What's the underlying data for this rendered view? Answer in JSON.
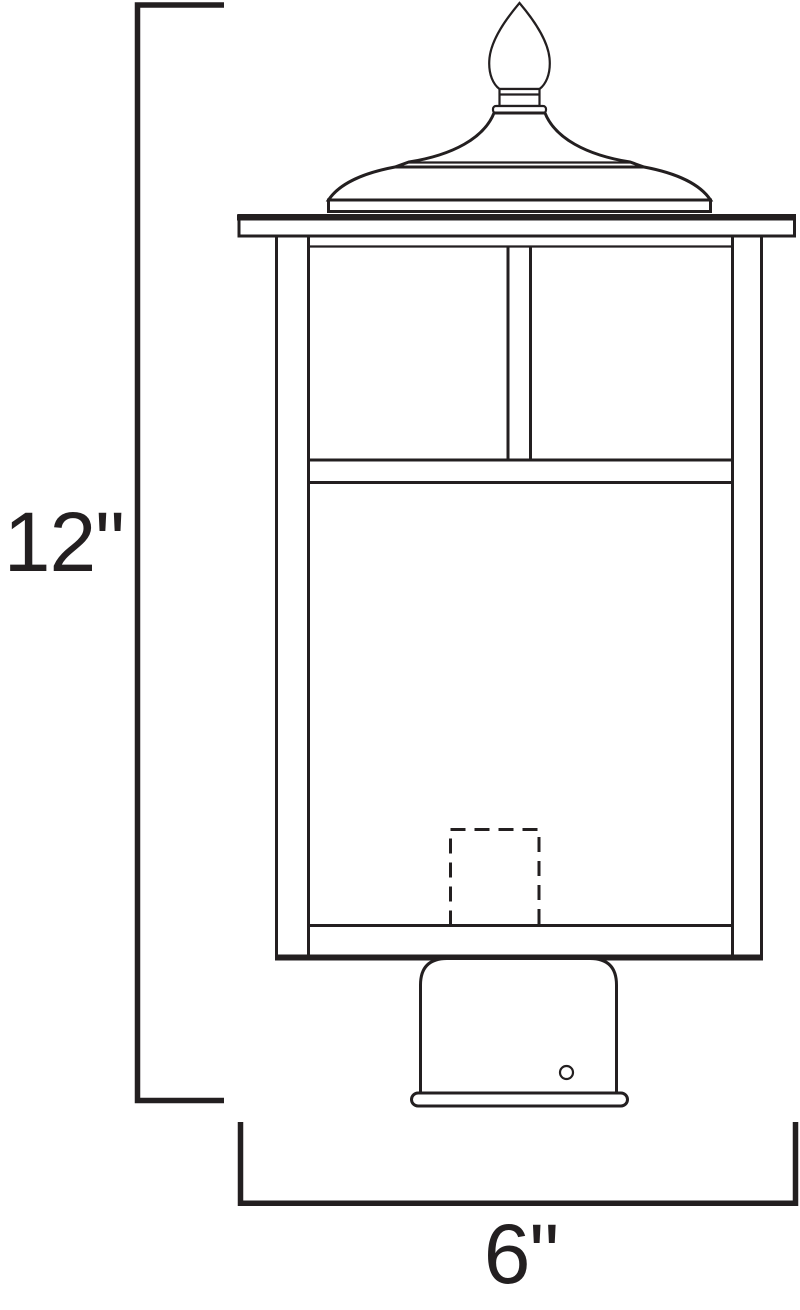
{
  "diagram": {
    "height_label": "12\"",
    "width_label": "6\"",
    "line_color": "#231f20",
    "background_color": "#ffffff"
  }
}
